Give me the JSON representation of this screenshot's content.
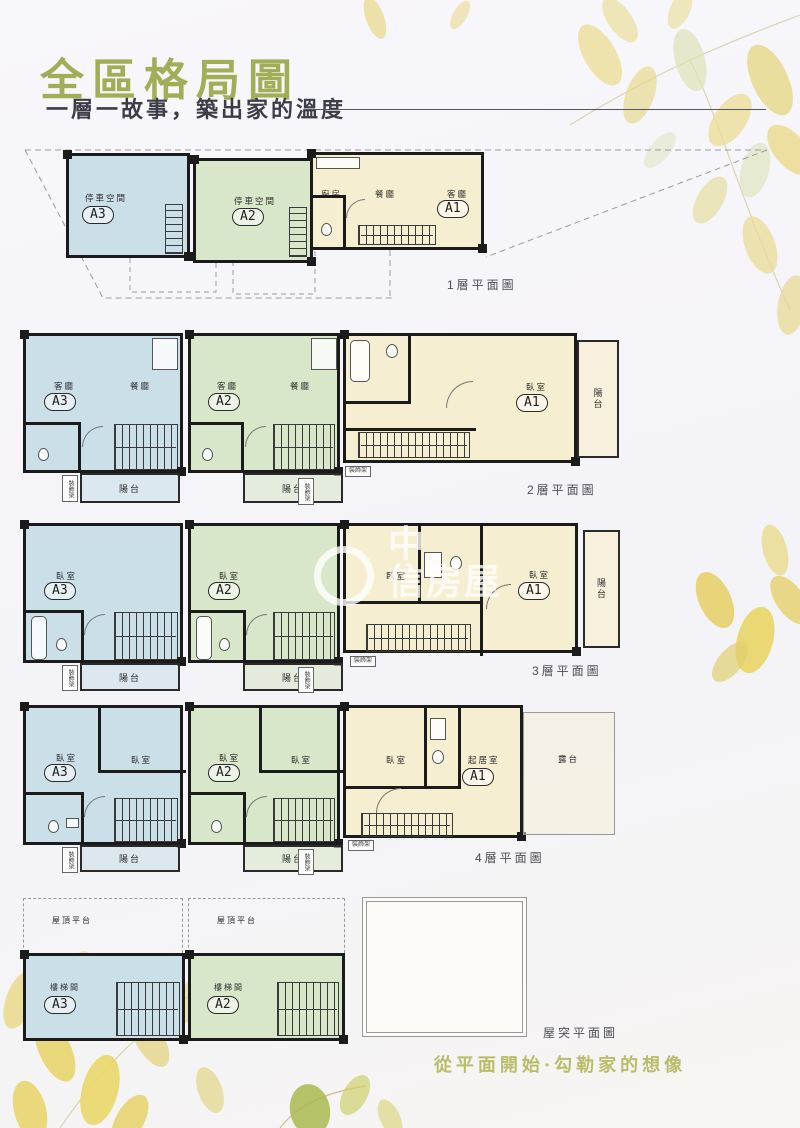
{
  "page": {
    "title": "全區格局圖",
    "subtitle": "一層一故事，築出家的溫度",
    "slogan": "從平面開始·勾勒家的想像",
    "watermark": {
      "l1": "中",
      "l2": "信房屋"
    }
  },
  "units": {
    "a1": "A1",
    "a2": "A2",
    "a3": "A3"
  },
  "labels": {
    "parking": "停車空間",
    "kitchen": "廚房",
    "dining": "餐廳",
    "living": "客廳",
    "bedroom": "臥室",
    "balcony": "陽台",
    "terrace": "露台",
    "sitting": "起居室",
    "stair_room": "樓梯間",
    "roof_deck": "屋頂平台",
    "shelf": "裝飾架"
  },
  "floors": {
    "f1": {
      "caption": "1層平面圖"
    },
    "f2": {
      "caption": "2層平面圖"
    },
    "f3": {
      "caption": "3層平面圖"
    },
    "f4": {
      "caption": "4層平面圖"
    },
    "roof": {
      "caption": "屋突平面圖"
    }
  },
  "colors": {
    "title": "#a2ae57",
    "slogan": "#b9bd68",
    "unit_a3": "#cbdfe9",
    "unit_a2": "#d8e6c9",
    "unit_a1": "#f6eed0",
    "wall": "#1b1b1b"
  }
}
